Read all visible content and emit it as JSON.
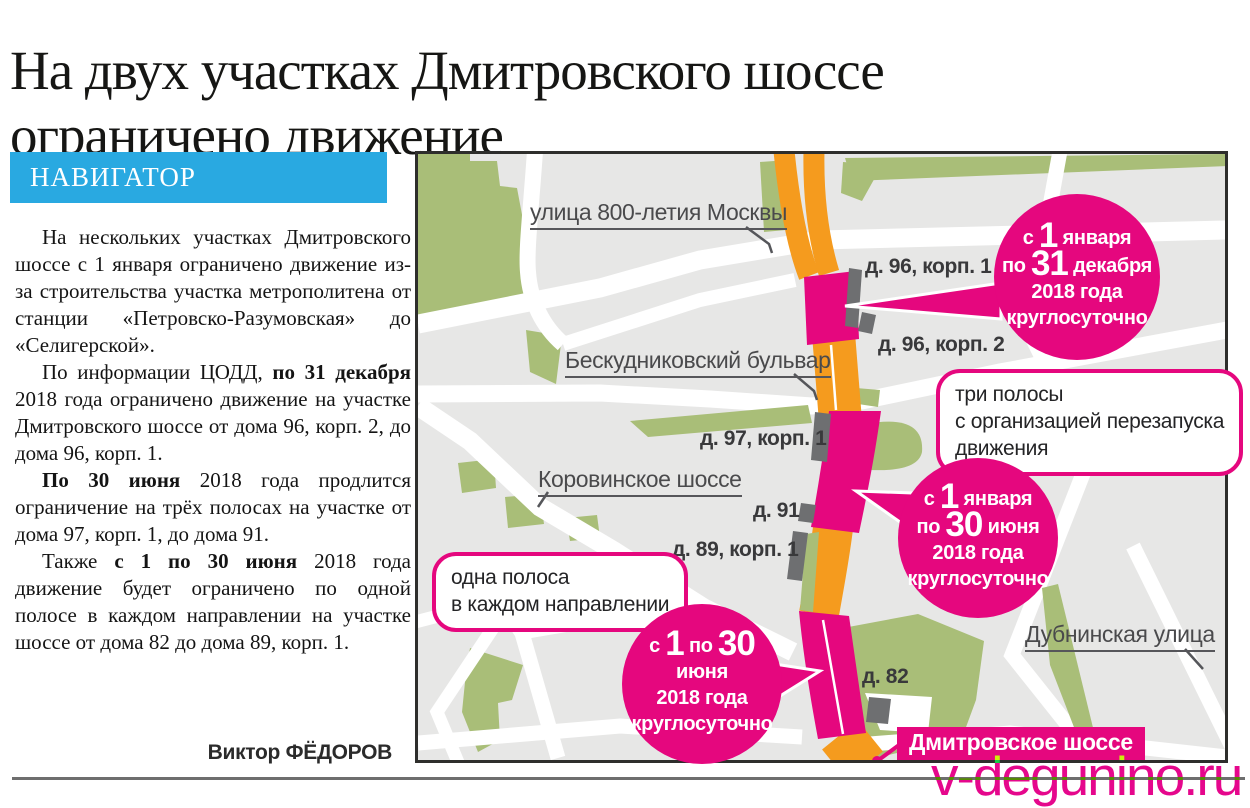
{
  "page": {
    "headline": "На двух участках Дмитровского шоссе ограничено движение",
    "kicker": "НАВИГАТОР",
    "author": "Виктор ФЁДОРОВ",
    "watermark": "v-degunino.ru"
  },
  "article": {
    "paragraphs": [
      {
        "segments": [
          {
            "t": "На нескольких участках Дмитровского шоссе с 1 января ограничено движение из-за строительства участка метрополитена от станции «Петровско-Разумовская» до «Селигерской»."
          }
        ]
      },
      {
        "segments": [
          {
            "t": "По информации ЦОДД, "
          },
          {
            "t": "по 31 декабря",
            "b": true
          },
          {
            "t": " 2018 года ограничено движение на участке Дмитровского шоссе от дома 96, корп. 2, до дома 96, корп. 1."
          }
        ]
      },
      {
        "segments": [
          {
            "t": "По 30 июня",
            "b": true
          },
          {
            "t": " 2018 года продлится ограничение на трёх полосах на участке от дома 97, корп. 1, до дома 91."
          }
        ]
      },
      {
        "segments": [
          {
            "t": "Также "
          },
          {
            "t": "с 1 по 30 июня",
            "b": true
          },
          {
            "t": " 2018 года движение будет ограничено по одной полосе в каждом направлении на участке шоссе от дома 82 до дома 89, корп. 1."
          }
        ]
      }
    ]
  },
  "map": {
    "streets": {
      "ul800": "улица 800-летия Москвы",
      "besk": "Бескудниковский бульвар",
      "korovinskoe": "Коровинское шоссе",
      "dubninskaya": "Дубнинская улица",
      "dmitrovskoe": "Дмитровское шоссе"
    },
    "buildings": [
      "д. 96, корп. 1",
      "д. 96, корп. 2",
      "д. 97, корп. 1",
      "д. 91",
      "д. 89, корп. 1",
      "д. 82"
    ],
    "callouts": [
      {
        "lines": [
          "три полосы",
          "с организацией перезапуска",
          "движения"
        ]
      },
      {
        "lines": [
          "одна полоса",
          "в каждом направлении"
        ]
      }
    ],
    "circles": [
      {
        "lines": [
          [
            {
              "t": "с "
            },
            {
              "t": "1",
              "big": true
            },
            {
              "t": " января"
            }
          ],
          [
            {
              "t": "по "
            },
            {
              "t": "31",
              "big": true
            },
            {
              "t": " декабря"
            }
          ],
          [
            {
              "t": "2018 года"
            }
          ],
          [
            {
              "t": "круглосуточно"
            }
          ]
        ]
      },
      {
        "lines": [
          [
            {
              "t": "с "
            },
            {
              "t": "1",
              "big": true
            },
            {
              "t": " января"
            }
          ],
          [
            {
              "t": "по "
            },
            {
              "t": "30",
              "big": true
            },
            {
              "t": " июня"
            }
          ],
          [
            {
              "t": "2018 года"
            }
          ],
          [
            {
              "t": "круглосуточно"
            }
          ]
        ]
      },
      {
        "lines": [
          [
            {
              "t": "с "
            },
            {
              "t": "1",
              "big": true
            },
            {
              "t": " по "
            },
            {
              "t": "30",
              "big": true
            },
            {
              "t": " июня"
            }
          ],
          [
            {
              "t": "2018 года"
            }
          ],
          [
            {
              "t": "круглосуточно"
            }
          ]
        ]
      }
    ],
    "colors": {
      "pink": "#E5077E",
      "orange": "#F59B1E",
      "green": "#A9BE78",
      "map_bg": "#E7E7E6",
      "blue": "#29A9E1",
      "building_gray": "#6E6F71"
    }
  }
}
